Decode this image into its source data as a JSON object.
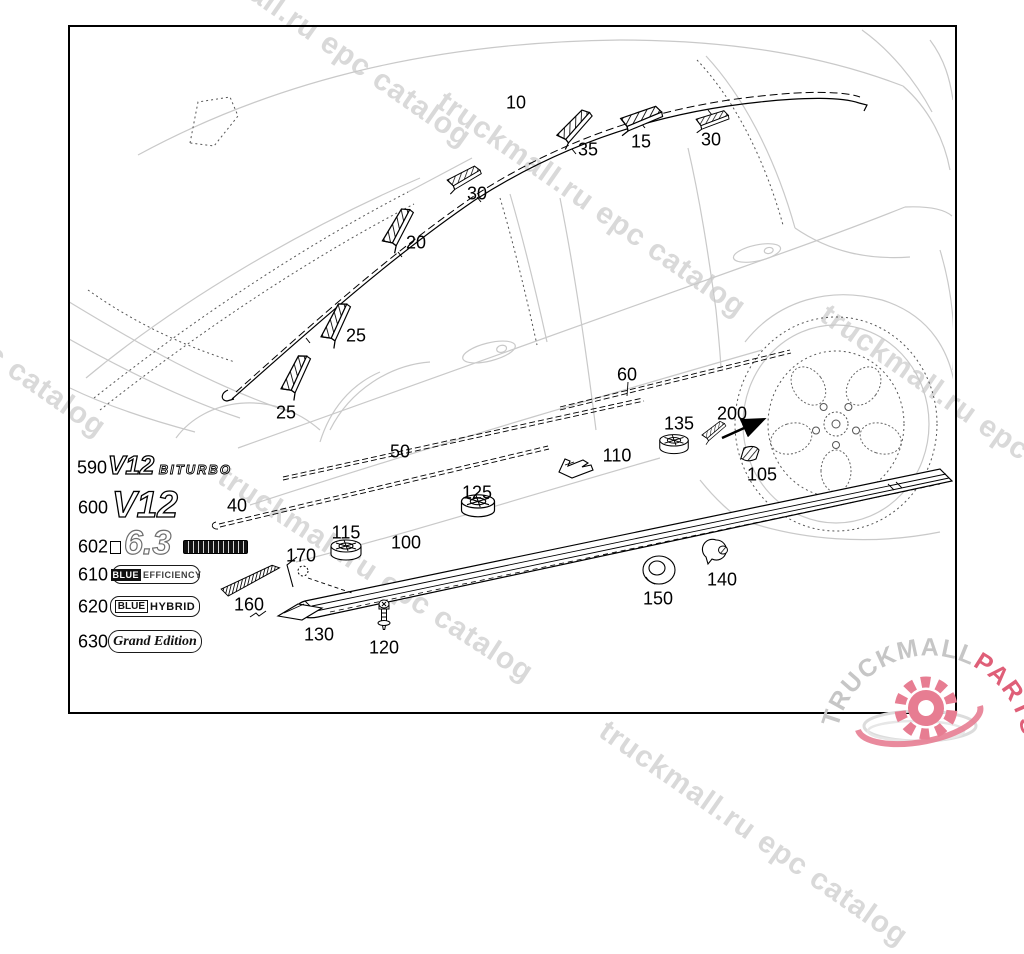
{
  "watermark": {
    "text": "truckmall.ru epc catalog",
    "color": "#d9d9d9"
  },
  "logo": {
    "text_primary": "TRUCKMALL",
    "text_secondary": "PARTS",
    "color_primary": "#c6c6c6",
    "color_secondary": "#df5f78",
    "gear_color": "#e77d92"
  },
  "callouts": [
    {
      "ref": "10",
      "x": 516,
      "y": 103
    },
    {
      "ref": "35",
      "x": 588,
      "y": 150
    },
    {
      "ref": "15",
      "x": 641,
      "y": 142
    },
    {
      "ref": "30",
      "x": 711,
      "y": 140
    },
    {
      "ref": "30",
      "x": 477,
      "y": 194
    },
    {
      "ref": "20",
      "x": 416,
      "y": 243
    },
    {
      "ref": "25",
      "x": 356,
      "y": 336
    },
    {
      "ref": "25",
      "x": 286,
      "y": 413
    },
    {
      "ref": "60",
      "x": 627,
      "y": 375
    },
    {
      "ref": "50",
      "x": 400,
      "y": 452
    },
    {
      "ref": "135",
      "x": 679,
      "y": 424
    },
    {
      "ref": "200",
      "x": 732,
      "y": 414
    },
    {
      "ref": "110",
      "x": 617,
      "y": 456
    },
    {
      "ref": "105",
      "x": 762,
      "y": 475
    },
    {
      "ref": "125",
      "x": 477,
      "y": 493
    },
    {
      "ref": "40",
      "x": 237,
      "y": 506
    },
    {
      "ref": "115",
      "x": 346,
      "y": 533
    },
    {
      "ref": "100",
      "x": 406,
      "y": 543
    },
    {
      "ref": "170",
      "x": 301,
      "y": 556
    },
    {
      "ref": "140",
      "x": 722,
      "y": 580
    },
    {
      "ref": "150",
      "x": 658,
      "y": 599
    },
    {
      "ref": "160",
      "x": 249,
      "y": 605
    },
    {
      "ref": "130",
      "x": 319,
      "y": 635
    },
    {
      "ref": "120",
      "x": 384,
      "y": 648
    }
  ],
  "badges": {
    "b590": {
      "ref": "590",
      "main": "V12",
      "sub": "BITURBO"
    },
    "b600": {
      "ref": "600",
      "main": "V12"
    },
    "b602": {
      "ref": "602",
      "main": "6.3"
    },
    "b610": {
      "ref": "610",
      "word1": "BLUE",
      "word2": "EFFICIENCY"
    },
    "b620": {
      "ref": "620",
      "word1": "BLUE",
      "word2": "HYBRID"
    },
    "b630": {
      "ref": "630",
      "script": "Grand Edition"
    }
  }
}
